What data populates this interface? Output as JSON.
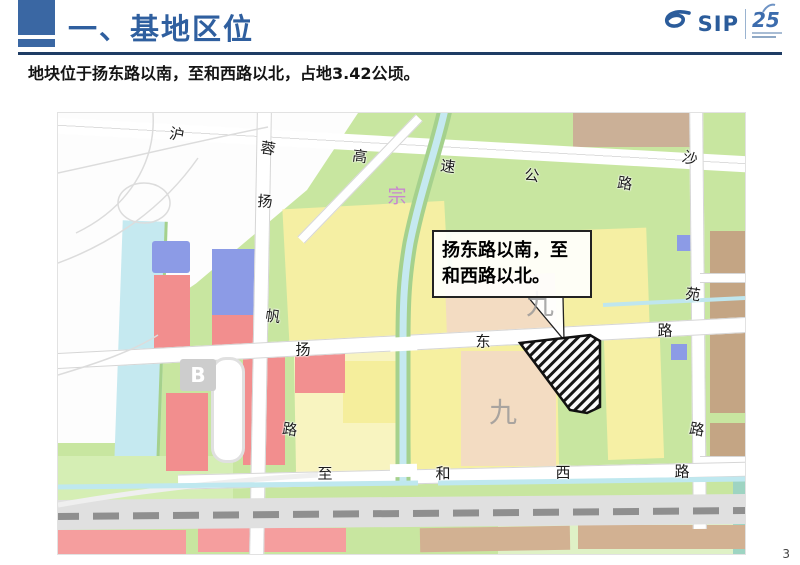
{
  "header": {
    "title": "一、基地区位",
    "logo": {
      "sip_text": "SIP",
      "anniversary_number": "25"
    }
  },
  "subtitle": "地块位于扬东路以南，至和西路以北，占地3.42公顷。",
  "page_number": "3",
  "map": {
    "callout": {
      "line1": "扬东路以南，至",
      "line2": "和西路以北。"
    },
    "expressway": [
      "沪",
      "蓉",
      "高",
      "速",
      "公",
      "路"
    ],
    "yangfan_road": [
      "扬",
      "帆",
      "路"
    ],
    "yangdong_road": [
      "扬",
      "东",
      "路"
    ],
    "zhihe_road": [
      "至",
      "和",
      "西",
      "路"
    ],
    "yuan_road": [
      "苑",
      "路"
    ],
    "sha_label": "沙",
    "zong_label": "宗",
    "jiu_label_1": "九",
    "jiu_label_2": "九",
    "b_label": "B"
  },
  "colors": {
    "accent_blue": "#2F5F9F",
    "underline_navy": "#1E3C64",
    "map_green": "#C8E6A0",
    "parcel_yellow": "#F5EFA3",
    "parcel_red": "#F28E8E",
    "parcel_blue": "#8C9BE6",
    "parcel_tan": "#CBB097",
    "parcel_peach": "#F3DCC2",
    "water_cyan": "#C5E9F0",
    "site_hatch": "#161616"
  }
}
